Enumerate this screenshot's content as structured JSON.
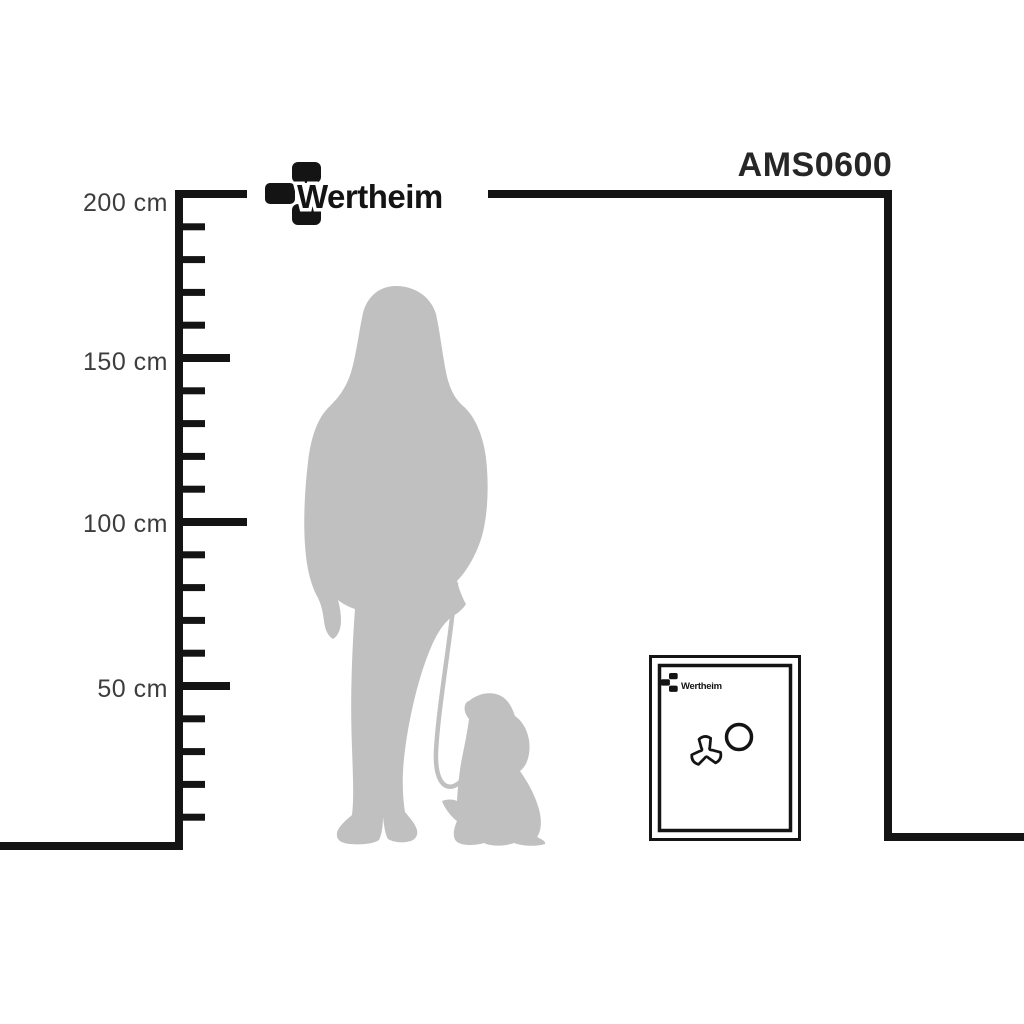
{
  "header": {
    "logo_text": "Wertheim",
    "model_label": "AMS0600"
  },
  "ruler": {
    "unit": "cm",
    "max_cm": 200,
    "minor_step_cm": 10,
    "major_step_cm": 50,
    "labels": [
      {
        "cm": 200,
        "text": "200 cm"
      },
      {
        "cm": 150,
        "text": "150 cm"
      },
      {
        "cm": 100,
        "text": "100 cm"
      },
      {
        "cm": 50,
        "text": "50 cm"
      }
    ]
  },
  "scene": {
    "person": {
      "name": "standing-woman-silhouette"
    },
    "dog": {
      "name": "sitting-dog-on-leash-silhouette"
    },
    "safe": {
      "label_text": "Wertheim",
      "features": [
        "tri-spoke-handle",
        "dial-ring"
      ]
    }
  },
  "colors": {
    "line": "#141414",
    "silhouette": "#c0c0c0",
    "label_text": "#3d3d3d",
    "model_text": "#262626",
    "background": "#ffffff"
  }
}
